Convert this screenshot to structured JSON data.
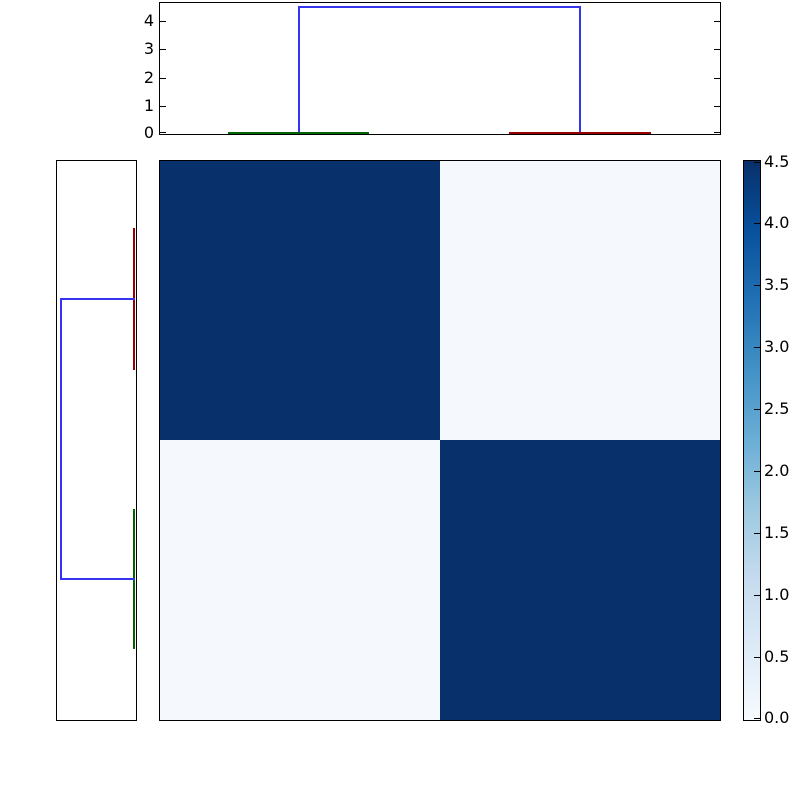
{
  "colors": {
    "background": "#ffffff",
    "axis_border": "#000000",
    "text": "#000000",
    "heat_high": "#08306b",
    "heat_low": "#f5f9fd",
    "link_blue": "#3434ee",
    "cluster_green": "#006400",
    "cluster_red": "#990000"
  },
  "chart_data": {
    "type": "heatmap",
    "title": "",
    "description": "Hierarchical clustering heatmap: 2x2 block distance matrix with top and left dendrograms and a vertical Blues colorbar",
    "heatmap": {
      "rows": 2,
      "cols": 2,
      "block_values": [
        [
          4.5,
          0.05
        ],
        [
          0.05,
          4.5
        ]
      ],
      "colormap": "Blues",
      "vmin": 0.0,
      "vmax": 4.5
    },
    "colorbar": {
      "orientation": "vertical",
      "range": [
        0.0,
        4.5
      ],
      "tick_labels": [
        "4.5",
        "4.0",
        "3.5",
        "3.0",
        "2.5",
        "2.0",
        "1.5",
        "1.0",
        "0.5",
        "0.0"
      ]
    },
    "top_dendrogram": {
      "orientation": "top",
      "y_axis_tick_labels": [
        "0",
        "1",
        "2",
        "3",
        "4"
      ],
      "merge_height": 4.5,
      "clusters": [
        {
          "color_name": "green",
          "collapse_height": 0.05,
          "position": "left"
        },
        {
          "color_name": "dark-red",
          "collapse_height": 0.05,
          "position": "right"
        }
      ],
      "link_color_name": "blue"
    },
    "left_dendrogram": {
      "orientation": "left",
      "merge_height": 4.5,
      "clusters": [
        {
          "color_name": "dark-red",
          "collapse_height": 0.05,
          "position": "top"
        },
        {
          "color_name": "green",
          "collapse_height": 0.05,
          "position": "bottom"
        }
      ],
      "link_color_name": "blue"
    }
  },
  "render": {
    "panels": [
      {
        "name": "top-dendrogram-panel",
        "left": 159,
        "top": 2,
        "width": 562,
        "height": 133
      },
      {
        "name": "left-dendrogram-panel",
        "left": 56,
        "top": 160,
        "width": 81,
        "height": 561
      },
      {
        "name": "heatmap-panel",
        "left": 159,
        "top": 160,
        "width": 562,
        "height": 561
      },
      {
        "name": "colorbar-panel",
        "left": 743,
        "top": 160,
        "width": 18,
        "height": 561
      }
    ],
    "cells": [
      {
        "name": "heatmap-cell-r0c0",
        "x": 160,
        "y": 161,
        "w": 280,
        "h": 279,
        "color": "#08306b"
      },
      {
        "name": "heatmap-cell-r0c1",
        "x": 440,
        "y": 161,
        "w": 280,
        "h": 279,
        "color": "#f5f9fd"
      },
      {
        "name": "heatmap-cell-r1c0",
        "x": 160,
        "y": 440,
        "w": 280,
        "h": 280,
        "color": "#f5f9fd"
      },
      {
        "name": "heatmap-cell-r1c1",
        "x": 440,
        "y": 440,
        "w": 280,
        "h": 280,
        "color": "#08306b"
      }
    ],
    "colorbar_gradient": {
      "name": "colorbar-gradient",
      "x": 744,
      "y": 161,
      "w": 16,
      "h": 559,
      "stops": [
        "#08306b",
        "#08519c",
        "#2171b5",
        "#4292c6",
        "#6baed6",
        "#9ecae1",
        "#c6dbef",
        "#deebf7",
        "#f7fbff"
      ]
    },
    "lines": [
      {
        "name": "top-dendrogram-link-left-vertical",
        "x": 298,
        "y": 6,
        "w": 2,
        "h": 128,
        "color": "#3434ee"
      },
      {
        "name": "top-dendrogram-link-bridge",
        "x": 298,
        "y": 6,
        "w": 283,
        "h": 2,
        "color": "#3434ee"
      },
      {
        "name": "top-dendrogram-link-right-vertical",
        "x": 579,
        "y": 6,
        "w": 2,
        "h": 128,
        "color": "#3434ee"
      },
      {
        "name": "top-dendrogram-cluster-green",
        "x": 228,
        "y": 132,
        "w": 141,
        "h": 2,
        "color": "#006400"
      },
      {
        "name": "top-dendrogram-cluster-red",
        "x": 509,
        "y": 132,
        "w": 142,
        "h": 2,
        "color": "#990000"
      },
      {
        "name": "left-dendrogram-cluster-red",
        "x": 133,
        "y": 228,
        "w": 2,
        "h": 142,
        "color": "#990000"
      },
      {
        "name": "left-dendrogram-cluster-green",
        "x": 133,
        "y": 509,
        "w": 2,
        "h": 140,
        "color": "#006400"
      },
      {
        "name": "left-dendrogram-link-top-horizontal",
        "x": 60,
        "y": 298,
        "w": 75,
        "h": 2,
        "color": "#3434ee"
      },
      {
        "name": "left-dendrogram-link-stem",
        "x": 60,
        "y": 298,
        "w": 2,
        "h": 282,
        "color": "#3434ee"
      },
      {
        "name": "left-dendrogram-link-bottom-horizontal",
        "x": 60,
        "y": 578,
        "w": 75,
        "h": 2,
        "color": "#3434ee"
      }
    ],
    "ticks": [
      {
        "name": "top-axis-left-tick-0",
        "x": 160,
        "y": 132,
        "w": 6,
        "h": 1
      },
      {
        "name": "top-axis-left-tick-1",
        "x": 160,
        "y": 106,
        "w": 6,
        "h": 1
      },
      {
        "name": "top-axis-left-tick-2",
        "x": 160,
        "y": 78,
        "w": 6,
        "h": 1
      },
      {
        "name": "top-axis-left-tick-3",
        "x": 160,
        "y": 49,
        "w": 6,
        "h": 1
      },
      {
        "name": "top-axis-left-tick-4",
        "x": 160,
        "y": 21,
        "w": 6,
        "h": 1
      },
      {
        "name": "top-axis-right-tick-0",
        "x": 714,
        "y": 132,
        "w": 6,
        "h": 1
      },
      {
        "name": "top-axis-right-tick-1",
        "x": 714,
        "y": 106,
        "w": 6,
        "h": 1
      },
      {
        "name": "top-axis-right-tick-2",
        "x": 714,
        "y": 78,
        "w": 6,
        "h": 1
      },
      {
        "name": "top-axis-right-tick-3",
        "x": 714,
        "y": 49,
        "w": 6,
        "h": 1
      },
      {
        "name": "top-axis-right-tick-4",
        "x": 714,
        "y": 21,
        "w": 6,
        "h": 1
      },
      {
        "name": "colorbar-tick-4-5",
        "x": 754,
        "y": 162,
        "w": 6,
        "h": 1
      },
      {
        "name": "colorbar-tick-4-0",
        "x": 754,
        "y": 223,
        "w": 6,
        "h": 1
      },
      {
        "name": "colorbar-tick-3-5",
        "x": 754,
        "y": 285,
        "w": 6,
        "h": 1
      },
      {
        "name": "colorbar-tick-3-0",
        "x": 754,
        "y": 347,
        "w": 6,
        "h": 1
      },
      {
        "name": "colorbar-tick-2-5",
        "x": 754,
        "y": 409,
        "w": 6,
        "h": 1
      },
      {
        "name": "colorbar-tick-2-0",
        "x": 754,
        "y": 471,
        "w": 6,
        "h": 1
      },
      {
        "name": "colorbar-tick-1-5",
        "x": 754,
        "y": 533,
        "w": 6,
        "h": 1
      },
      {
        "name": "colorbar-tick-1-0",
        "x": 754,
        "y": 595,
        "w": 6,
        "h": 1
      },
      {
        "name": "colorbar-tick-0-5",
        "x": 754,
        "y": 657,
        "w": 6,
        "h": 1
      },
      {
        "name": "colorbar-tick-0-0",
        "x": 754,
        "y": 718,
        "w": 6,
        "h": 1
      }
    ],
    "labels": [
      {
        "name": "top-axis-label-4",
        "text": "4",
        "x": 120,
        "y": 11,
        "w": 34,
        "align": "right"
      },
      {
        "name": "top-axis-label-3",
        "text": "3",
        "x": 120,
        "y": 39,
        "w": 34,
        "align": "right"
      },
      {
        "name": "top-axis-label-2",
        "text": "2",
        "x": 120,
        "y": 68,
        "w": 34,
        "align": "right"
      },
      {
        "name": "top-axis-label-1",
        "text": "1",
        "x": 120,
        "y": 96,
        "w": 34,
        "align": "right"
      },
      {
        "name": "top-axis-label-0",
        "text": "0",
        "x": 120,
        "y": 123,
        "w": 34,
        "align": "right"
      },
      {
        "name": "colorbar-label-4-5",
        "text": "4.5",
        "x": 764,
        "y": 152,
        "w": 40,
        "align": "left"
      },
      {
        "name": "colorbar-label-4-0",
        "text": "4.0",
        "x": 764,
        "y": 213,
        "w": 40,
        "align": "left"
      },
      {
        "name": "colorbar-label-3-5",
        "text": "3.5",
        "x": 764,
        "y": 275,
        "w": 40,
        "align": "left"
      },
      {
        "name": "colorbar-label-3-0",
        "text": "3.0",
        "x": 764,
        "y": 337,
        "w": 40,
        "align": "left"
      },
      {
        "name": "colorbar-label-2-5",
        "text": "2.5",
        "x": 764,
        "y": 399,
        "w": 40,
        "align": "left"
      },
      {
        "name": "colorbar-label-2-0",
        "text": "2.0",
        "x": 764,
        "y": 461,
        "w": 40,
        "align": "left"
      },
      {
        "name": "colorbar-label-1-5",
        "text": "1.5",
        "x": 764,
        "y": 523,
        "w": 40,
        "align": "left"
      },
      {
        "name": "colorbar-label-1-0",
        "text": "1.0",
        "x": 764,
        "y": 585,
        "w": 40,
        "align": "left"
      },
      {
        "name": "colorbar-label-0-5",
        "text": "0.5",
        "x": 764,
        "y": 647,
        "w": 40,
        "align": "left"
      },
      {
        "name": "colorbar-label-0-0",
        "text": "0.0",
        "x": 764,
        "y": 708,
        "w": 40,
        "align": "left"
      }
    ]
  }
}
